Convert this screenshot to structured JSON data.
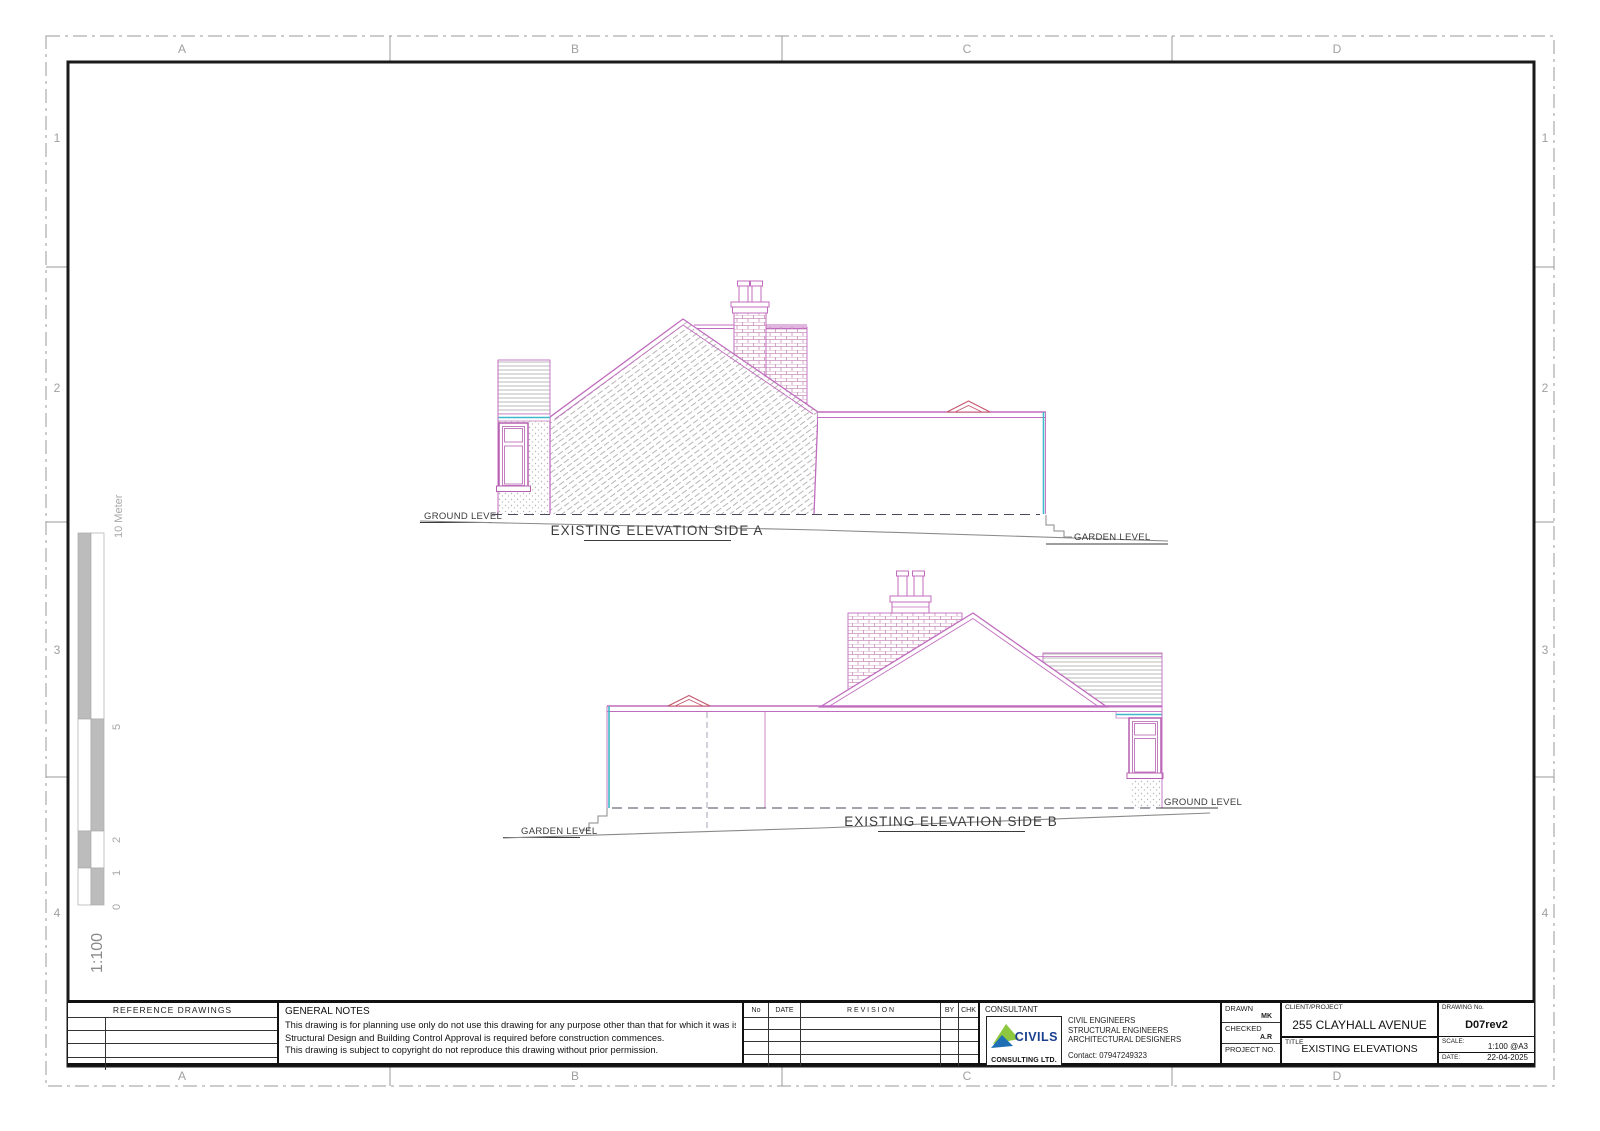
{
  "colors": {
    "outline_magenta": "#c06cbe",
    "window_magenta": "#b55fb0",
    "brick_line": "#c98fbb",
    "ornament_red": "#c4566c",
    "accent_cyan": "#3fb8c9",
    "hatch_gray": "#b5b2b2",
    "level_dash": "#4a4a5e",
    "ground_gray": "#8a8a8a",
    "label_gray": "#a0a0a0",
    "text_dark": "#3b3b3b",
    "logo_green": "#8dc63f",
    "logo_blue": "#1f6fb5"
  },
  "grid": {
    "cols": [
      "A",
      "B",
      "C",
      "D"
    ],
    "rows": [
      "1",
      "2",
      "3",
      "4"
    ]
  },
  "scale_bar": {
    "top_label": "10 Meter",
    "tick_5": "5",
    "tick_2": "2",
    "tick_1": "1",
    "tick_0": "0",
    "ratio": "1:100"
  },
  "side_a": {
    "caption": "EXISTING ELEVATION SIDE A",
    "ground_level": "GROUND LEVEL",
    "garden_level": "GARDEN LEVEL"
  },
  "side_b": {
    "caption": "EXISTING ELEVATION SIDE B",
    "ground_level": "GROUND LEVEL",
    "garden_level": "GARDEN LEVEL"
  },
  "title_block": {
    "reference": {
      "header": "REFERENCE  DRAWINGS"
    },
    "notes": {
      "header": "GENERAL NOTES",
      "line1": "This drawing is for planning use only do not use this drawing for any purpose other than that for which it was issued.",
      "line2": "Structural Design and Building Control Approval is required before construction commences.",
      "line3": "This drawing is subject to copyright do not reproduce this drawing without prior permission."
    },
    "revision": {
      "no": "No",
      "date": "DATE",
      "revision": "R E V I S I O N",
      "by": "BY",
      "chk": "CHK"
    },
    "consultant": {
      "header": "CONSULTANT",
      "logo_text": "CIVILS",
      "logo_sub": "CONSULTING LTD.",
      "service1": "CIVIL ENGINEERS",
      "service2": "STRUCTURAL ENGINEERS",
      "service3": "ARCHITECTURAL DESIGNERS",
      "contact": "Contact: 07947249323"
    },
    "drawn_label": "DRAWN",
    "drawn_value": "MK",
    "checked_label": "CHECKED",
    "checked_value": "A.R",
    "project_label": "PROJECT  NO.",
    "client_label": "CLIENT/PROJECT",
    "client_value": "255 CLAYHALL AVENUE",
    "title_label": "TITLE",
    "title_value": "EXISTING ELEVATIONS",
    "drawing_no_label": "DRAWING  No.",
    "drawing_no_value": "D07rev2",
    "scale_label": "SCALE:",
    "scale_value": "1:100  @A3",
    "date_label": "DATE:",
    "date_value": "22-04-2025"
  }
}
